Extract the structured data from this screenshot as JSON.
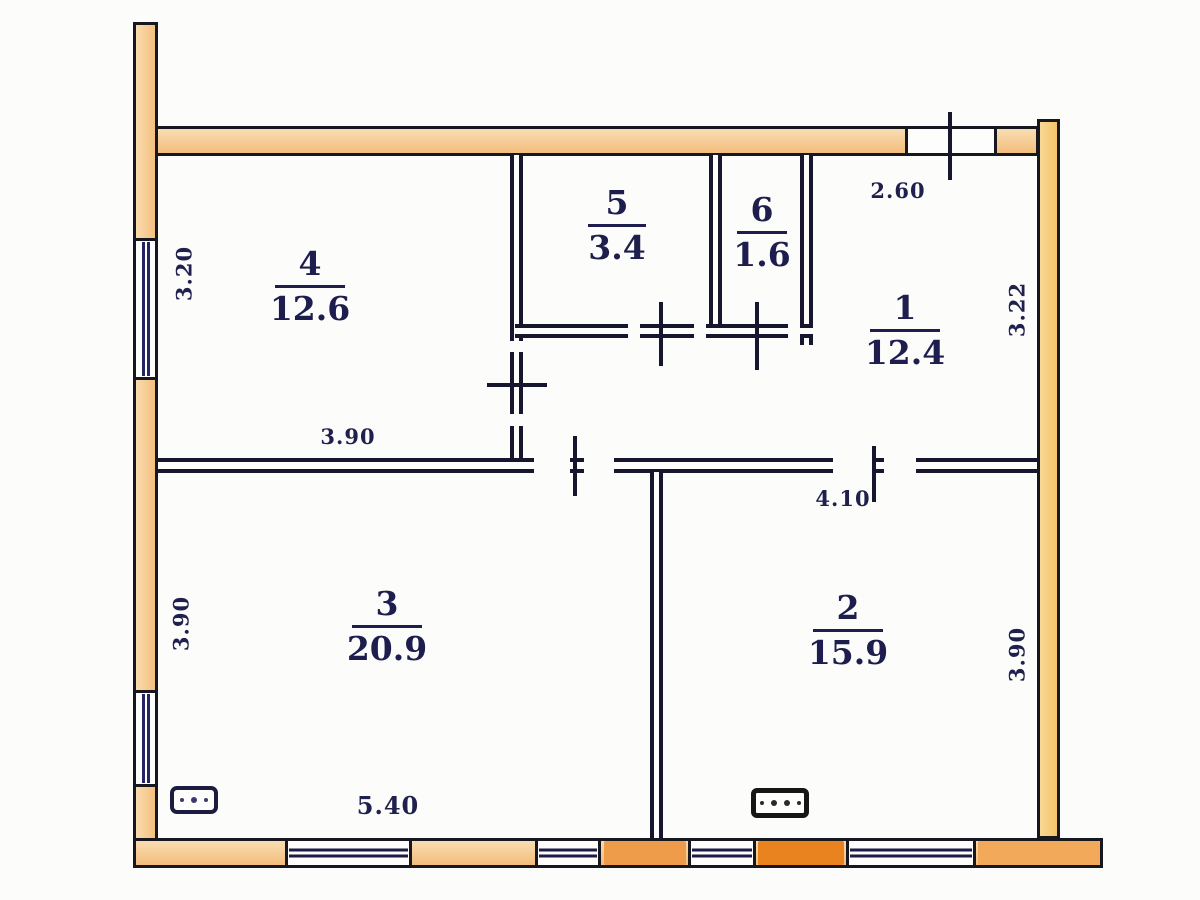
{
  "drawing": {
    "type": "floor-plan"
  },
  "rooms": {
    "r1": {
      "number": "1",
      "area": "12.4"
    },
    "r2": {
      "number": "2",
      "area": "15.9"
    },
    "r3": {
      "number": "3",
      "area": "20.9"
    },
    "r4": {
      "number": "4",
      "area": "12.6"
    },
    "r5": {
      "number": "5",
      "area": "3.4"
    },
    "r6": {
      "number": "6",
      "area": "1.6"
    }
  },
  "dimensions": {
    "left_upper": "3.20",
    "top_right": "2.60",
    "right_upper": "3.22",
    "inner_left": "3.90",
    "inner_right": "4.10",
    "left_lower": "3.90",
    "right_lower": "3.90",
    "bottom": "5.40"
  },
  "colors": {
    "wall_fill": "#f5c78d",
    "wall_fill_mid": "#ef9c4a",
    "wall_fill_bright": "#e8831f",
    "wall_fill_right": "#f2a959",
    "outline": "#17171f",
    "interior_wall": "#16162e",
    "text": "#1d1d4e",
    "background": "#fcfcfb"
  }
}
